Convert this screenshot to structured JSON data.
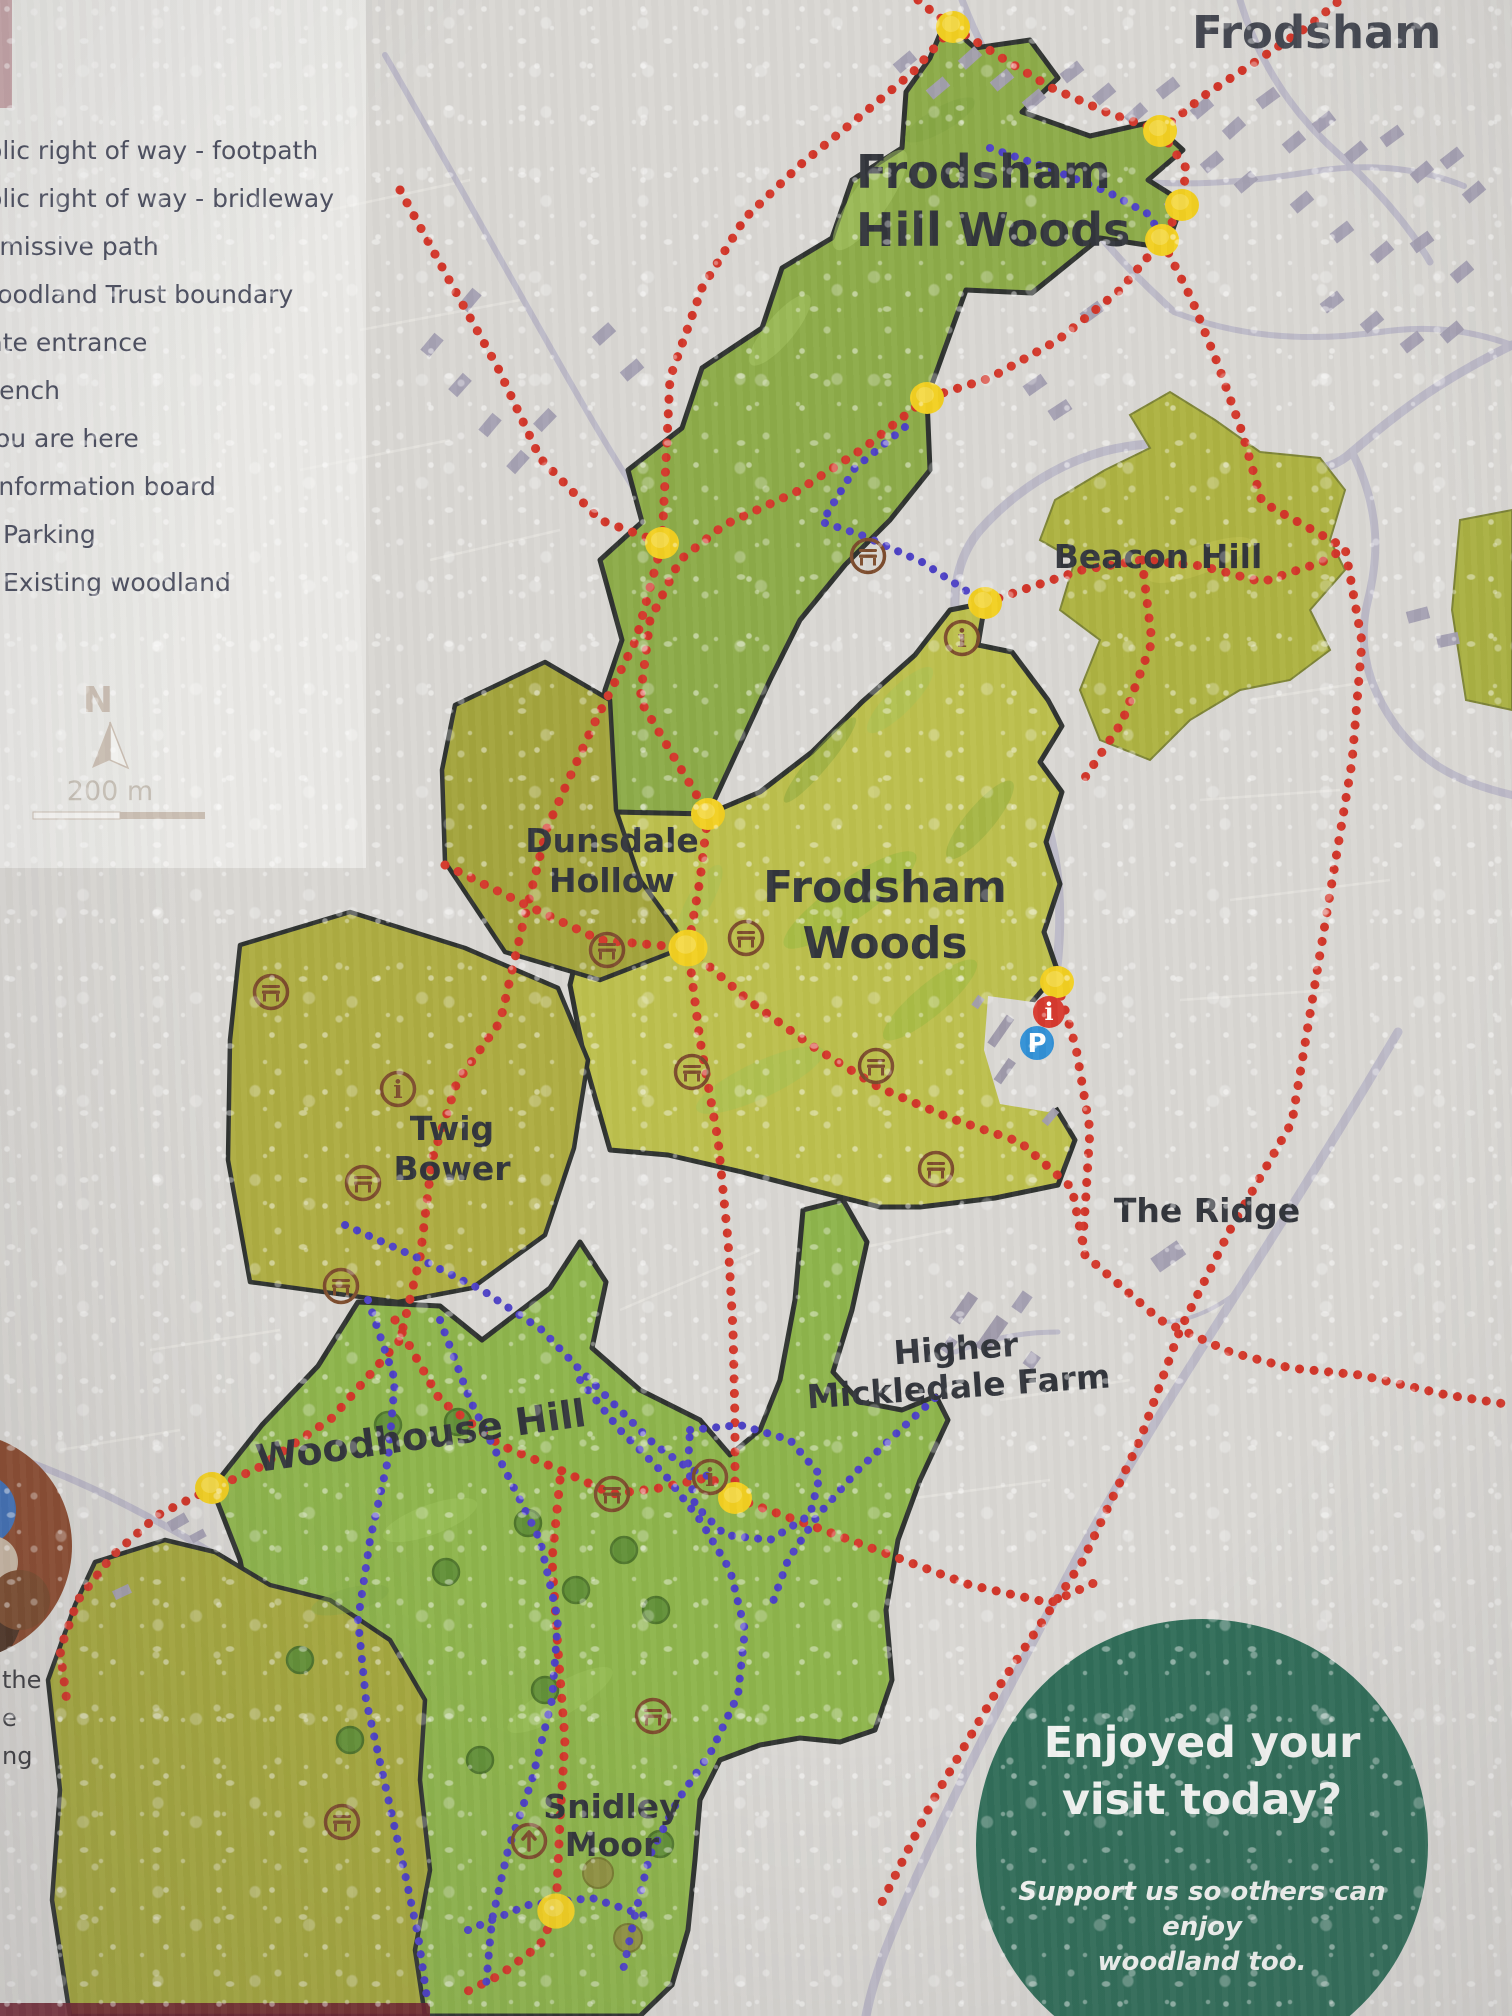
{
  "legend": {
    "items": [
      "Public right of way - footpath",
      "Public right of way - bridleway",
      "Permissive path",
      "Woodland Trust boundary",
      "Gate entrance",
      "Bench",
      "You are here",
      "Information board",
      "Parking",
      "Existing woodland"
    ]
  },
  "compass": {
    "north": "N",
    "scale": "200 m"
  },
  "map_labels": {
    "town": "Frodsham",
    "hill_woods": [
      "Frodsham",
      "Hill Woods"
    ],
    "beacon_hill": "Beacon Hill",
    "dunsdale": [
      "Dunsdale",
      "Hollow"
    ],
    "frodsham_woods": [
      "Frodsham",
      "Woods"
    ],
    "twig_bower": [
      "Twig",
      "Bower"
    ],
    "the_ridge": "The Ridge",
    "mickledale": [
      "Higher",
      "Mickledale Farm"
    ],
    "woodhouse": "Woodhouse Hill",
    "snidley": [
      "Snidley",
      "Moor"
    ]
  },
  "icons": {
    "info_board_glyph": "i",
    "info_point_glyph": "i",
    "parking_glyph": "P"
  },
  "promo": {
    "heading": [
      "Enjoyed your",
      "visit today?"
    ],
    "body": [
      "Support us so others can enjoy",
      "woodland too."
    ],
    "cta": [
      "Call 0330 333 3300 or go to",
      "woodlandtrust.org.uk"
    ]
  },
  "photo_caption_fragments": [
    "the",
    "e",
    "ng"
  ],
  "colors": {
    "woodland_green": "#8cab47",
    "woodland_yellow_green": "#bcbf4b",
    "woodland_olive": "#a3a43a",
    "footpath_red": "#d23427",
    "permissive_path_blue": "#4b3fc4",
    "woodland_trust_boundary": "#2d312e",
    "gate_yellow": "#f2cf1e",
    "icon_brown": "#7b4a2a",
    "parking_blue": "#2f8fd5",
    "info_point_red": "#d6372c",
    "promo_green": "#2e6c57"
  }
}
